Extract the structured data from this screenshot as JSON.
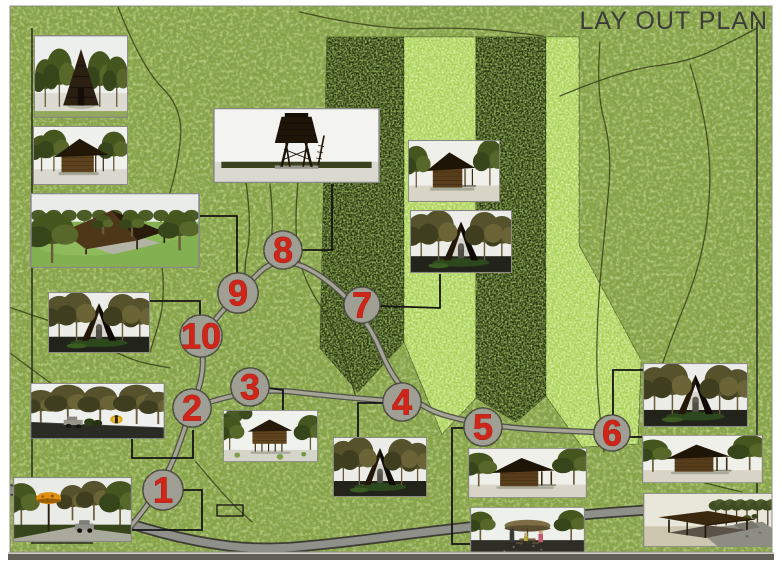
{
  "title": "LAY OUT PLAN",
  "map": {
    "colors": {
      "grass": "#87a447",
      "band_dark": "#25310d",
      "band_light": "#a6cf58",
      "road_fill": "#8f908a",
      "road_edge": "#3d3d34",
      "path_fill": "#a5a497",
      "path_edge": "#54544a",
      "circle_fill": "#9d9d94",
      "circle_edge": "#43433a",
      "number": "#d0261a",
      "number_edge": "#8f1008",
      "connector": "#141414",
      "contour": "#3a421d",
      "boundary": "#2b2b22",
      "title": "#3c3c3c",
      "photo_border": "#8a8a82",
      "frame_shadow": "#615f57"
    },
    "stations": [
      {
        "n": "1",
        "x": 163,
        "y": 490,
        "r": 20
      },
      {
        "n": "2",
        "x": 192,
        "y": 408,
        "r": 19
      },
      {
        "n": "3",
        "x": 250,
        "y": 387,
        "r": 19
      },
      {
        "n": "4",
        "x": 402,
        "y": 402,
        "r": 19
      },
      {
        "n": "5",
        "x": 483,
        "y": 427,
        "r": 19
      },
      {
        "n": "6",
        "x": 612,
        "y": 433,
        "r": 18
      },
      {
        "n": "7",
        "x": 362,
        "y": 305,
        "r": 18
      },
      {
        "n": "8",
        "x": 283,
        "y": 250,
        "r": 19
      },
      {
        "n": "9",
        "x": 238,
        "y": 293,
        "r": 20
      },
      {
        "n": "10",
        "x": 201,
        "y": 336,
        "r": 21
      }
    ],
    "photos": [
      {
        "id": "teepee-hut",
        "type": "teepee",
        "x": 34,
        "y": 35,
        "w": 94,
        "h": 83
      },
      {
        "id": "log-cabin",
        "type": "cabin",
        "x": 33,
        "y": 126,
        "w": 95,
        "h": 59
      },
      {
        "id": "open-shelter",
        "type": "openshelter",
        "x": 30,
        "y": 193,
        "w": 170,
        "h": 75
      },
      {
        "id": "aframe-shelter",
        "type": "aframe",
        "x": 48,
        "y": 292,
        "w": 102,
        "h": 61
      },
      {
        "id": "trail-vehicle",
        "type": "trailscene",
        "x": 30,
        "y": 383,
        "w": 135,
        "h": 56
      },
      {
        "id": "lamp-car",
        "type": "lampscene",
        "x": 13,
        "y": 477,
        "w": 119,
        "h": 65
      },
      {
        "id": "watch-tower",
        "type": "tower",
        "x": 213,
        "y": 108,
        "w": 167,
        "h": 75
      },
      {
        "id": "stilt-cabin",
        "type": "stiltcabin",
        "x": 223,
        "y": 410,
        "w": 95,
        "h": 52
      },
      {
        "id": "aframe-hut-c",
        "type": "aframe",
        "x": 333,
        "y": 437,
        "w": 94,
        "h": 60
      },
      {
        "id": "cabin-mid",
        "type": "cabin2",
        "x": 408,
        "y": 140,
        "w": 92,
        "h": 62
      },
      {
        "id": "aframe-shrine",
        "type": "aframe",
        "x": 410,
        "y": 210,
        "w": 102,
        "h": 63
      },
      {
        "id": "cabin-south",
        "type": "cabin2",
        "x": 468,
        "y": 448,
        "w": 119,
        "h": 50
      },
      {
        "id": "umbrella-picnic",
        "type": "umbrella",
        "x": 470,
        "y": 507,
        "w": 115,
        "h": 51
      },
      {
        "id": "aframe-east",
        "type": "aframe",
        "x": 643,
        "y": 363,
        "w": 105,
        "h": 64
      },
      {
        "id": "cabin-east",
        "type": "cabin2",
        "x": 642,
        "y": 435,
        "w": 121,
        "h": 48
      },
      {
        "id": "flat-shelter",
        "type": "flatshelter",
        "x": 643,
        "y": 493,
        "w": 130,
        "h": 54
      }
    ],
    "trail": [
      [
        124,
        534
      ],
      [
        163,
        490
      ],
      [
        192,
        408
      ],
      [
        204,
        372
      ],
      [
        201,
        336
      ],
      [
        238,
        293
      ],
      [
        283,
        250
      ],
      [
        362,
        305
      ],
      [
        402,
        402
      ],
      [
        483,
        427
      ],
      [
        612,
        433
      ]
    ],
    "trail_branch": [
      [
        192,
        408
      ],
      [
        250,
        387
      ],
      [
        330,
        396
      ],
      [
        402,
        402
      ]
    ],
    "road": [
      [
        0,
        488
      ],
      [
        58,
        498
      ],
      [
        128,
        524
      ],
      [
        196,
        542
      ],
      [
        262,
        550
      ],
      [
        340,
        543
      ],
      [
        432,
        531
      ],
      [
        516,
        522
      ],
      [
        598,
        513
      ],
      [
        700,
        507
      ],
      [
        782,
        503
      ]
    ],
    "bands": [
      {
        "kind": "dark",
        "pts": [
          [
            327,
            37
          ],
          [
            404,
            37
          ],
          [
            404,
            342
          ],
          [
            358,
            392
          ],
          [
            320,
            348
          ]
        ]
      },
      {
        "kind": "light",
        "pts": [
          [
            404,
            37
          ],
          [
            476,
            37
          ],
          [
            476,
            398
          ],
          [
            442,
            434
          ],
          [
            404,
            342
          ]
        ]
      },
      {
        "kind": "dark",
        "pts": [
          [
            476,
            37
          ],
          [
            546,
            37
          ],
          [
            546,
            396
          ],
          [
            516,
            422
          ],
          [
            476,
            398
          ]
        ]
      },
      {
        "kind": "light",
        "pts": [
          [
            546,
            37
          ],
          [
            579,
            37
          ],
          [
            579,
            245
          ],
          [
            641,
            360
          ],
          [
            638,
            444
          ],
          [
            582,
            447
          ],
          [
            546,
            396
          ]
        ]
      }
    ],
    "contours": [
      [
        [
          118,
          7
        ],
        [
          142,
          68
        ],
        [
          183,
          108
        ],
        [
          178,
          168
        ],
        [
          158,
          230
        ],
        [
          166,
          300
        ],
        [
          150,
          352
        ]
      ],
      [
        [
          300,
          12
        ],
        [
          376,
          30
        ],
        [
          468,
          27
        ],
        [
          543,
          36
        ]
      ],
      [
        [
          560,
          96
        ],
        [
          622,
          70
        ],
        [
          688,
          62
        ],
        [
          735,
          40
        ],
        [
          757,
          28
        ]
      ],
      [
        [
          690,
          64
        ],
        [
          704,
          110
        ],
        [
          712,
          180
        ],
        [
          702,
          262
        ],
        [
          668,
          346
        ],
        [
          644,
          420
        ]
      ],
      [
        [
          600,
          42
        ],
        [
          596,
          90
        ],
        [
          612,
          150
        ],
        [
          606,
          220
        ],
        [
          598,
          300
        ],
        [
          596,
          380
        ],
        [
          604,
          452
        ]
      ],
      [
        [
          246,
          182
        ],
        [
          252,
          228
        ],
        [
          243,
          272
        ],
        [
          250,
          310
        ]
      ],
      [
        [
          270,
          184
        ],
        [
          274,
          222
        ],
        [
          268,
          258
        ]
      ],
      [
        [
          298,
          182
        ],
        [
          294,
          226
        ],
        [
          302,
          278
        ],
        [
          338,
          332
        ],
        [
          356,
          398
        ]
      ],
      [
        [
          196,
          462
        ],
        [
          226,
          498
        ],
        [
          252,
          522
        ]
      ],
      [
        [
          96,
          342
        ],
        [
          128,
          360
        ],
        [
          170,
          368
        ]
      ],
      [
        [
          6,
          306
        ],
        [
          40,
          318
        ],
        [
          80,
          330
        ]
      ],
      [
        [
          6,
          350
        ],
        [
          30,
          368
        ],
        [
          60,
          390
        ]
      ],
      [
        [
          660,
          470
        ],
        [
          700,
          482
        ],
        [
          742,
          492
        ]
      ]
    ],
    "boundaries": [
      [
        [
          32,
          28
        ],
        [
          32,
          543
        ],
        [
          93,
          543
        ]
      ],
      [
        [
          757,
          22
        ],
        [
          757,
          546
        ]
      ]
    ],
    "connectors": [
      [
        [
          200,
          216
        ],
        [
          237,
          216
        ],
        [
          237,
          274
        ]
      ],
      [
        [
          150,
          301
        ],
        [
          200,
          301
        ],
        [
          200,
          327
        ]
      ],
      [
        [
          132,
          438
        ],
        [
          132,
          458
        ],
        [
          193,
          458
        ],
        [
          193,
          430
        ]
      ],
      [
        [
          132,
          530
        ],
        [
          202,
          530
        ],
        [
          202,
          490
        ],
        [
          183,
          490
        ]
      ],
      [
        [
          332,
          184
        ],
        [
          332,
          250
        ],
        [
          302,
          250
        ]
      ],
      [
        [
          283,
          410
        ],
        [
          283,
          390
        ],
        [
          268,
          388
        ]
      ],
      [
        [
          358,
          437
        ],
        [
          358,
          403
        ],
        [
          384,
          403
        ]
      ],
      [
        [
          440,
          274
        ],
        [
          440,
          308
        ],
        [
          380,
          306
        ]
      ],
      [
        [
          464,
          428
        ],
        [
          452,
          428
        ],
        [
          452,
          544
        ],
        [
          470,
          544
        ]
      ],
      [
        [
          613,
          415
        ],
        [
          613,
          370
        ],
        [
          643,
          370
        ]
      ],
      [
        [
          630,
          437
        ],
        [
          643,
          437
        ]
      ]
    ],
    "footprints": [
      [
        217,
        505,
        26,
        11
      ]
    ]
  }
}
